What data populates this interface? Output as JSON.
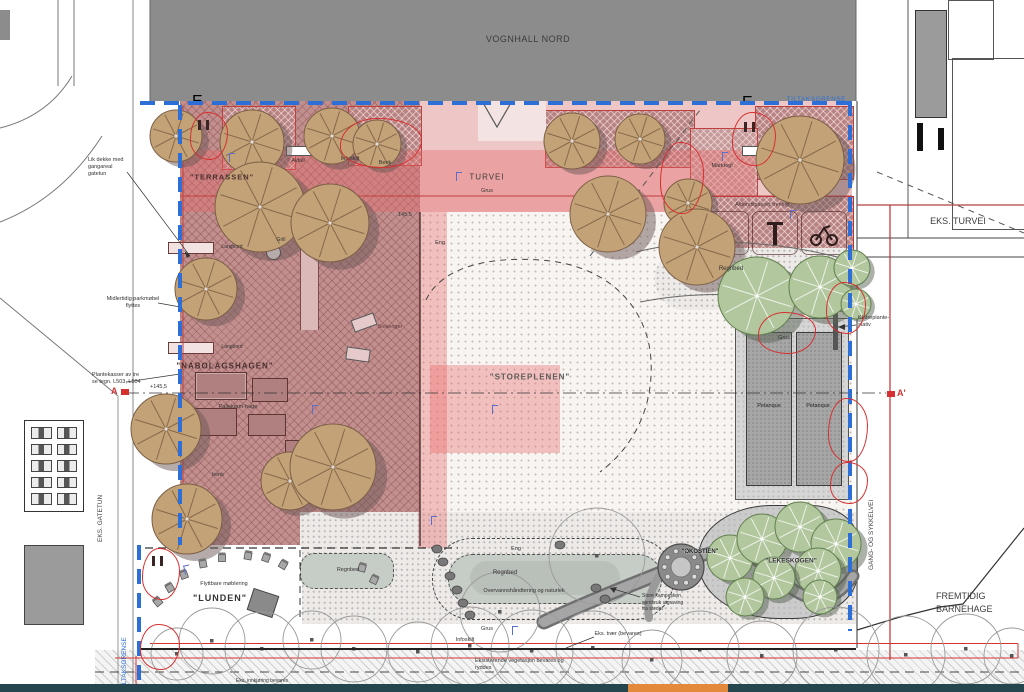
{
  "buildings": {
    "vognhall_nord": "VOGNHALL NORD",
    "fremtidig_barnehage": "FREMTIDIG\nBARNEHAGE"
  },
  "roads": {
    "eks_turvei": "EKS. TURVEI",
    "gang_og_sykkelvei": "GANG- OG SYKKELVEI",
    "eks_gatetun": "EKS. GATETUN"
  },
  "boundary": {
    "tiltaksgrense_top": "TILTAKSGRENSE",
    "tiltaksgrense_left": "TILTAKSGRENSE"
  },
  "areas": {
    "terrassen": "\"TERRASSEN\"",
    "nabolagshagen": "\"NABOLAGSHAGEN\"",
    "storeplenen": "\"STOREPLENEN\"",
    "lunden": "\"LUNDEN\"",
    "lekeskogen": "\"LEKESKOGEN\"",
    "okostien": "\"ØKOSTIEN\""
  },
  "turvei": {
    "name": "TURVEI",
    "surface": "Grus"
  },
  "labels": {
    "avfall": "Avfall",
    "infoskilt": "Infoskilt",
    "benk": "Benk",
    "marktegl": "Marktegl",
    "alderstilpasset_trening": "Alderstilpasset trening",
    "regnbed": "Regnbed",
    "grus": "Grus",
    "petanque": "Petanque",
    "langbord": "Langbord",
    "grill": "Grill",
    "pallekarm_hage": "Pallekarm-hage",
    "benk_small": "benk",
    "solsenger": "Solsenger",
    "eng": "Eng",
    "overvann": "Overvannshåndtering og naturlek",
    "flyttbar_moblering": "Flyttbare møblering",
    "eks_traer": "Eks. trær (bevares)",
    "eks_innkjoring": "Eks. innkjøring bevares"
  },
  "annotations": {
    "lik_dekke": "Lik dekke med\ngangareal\ngatetun",
    "midlertidig_parkmobel": "Midlertidig parkmøbel\nflyttes",
    "plantekasser": "Plantekasser av tre\nse tegn. L503, L504",
    "klatreplante_stativ": "Klatreplante-\nstativ",
    "store_kampestein": "Store kampestein\ngjenbruk utgraving\nfra stedet",
    "eksisterende_vegetasjon": "Eksisterende vegetasjon bevares og\nryddes"
  },
  "elevations": {
    "spot_1": "+145,5",
    "spot_2": "145,5"
  },
  "section": {
    "a": "A",
    "a_prime": "A'"
  },
  "markers": {
    "revision": "E"
  },
  "colors": {
    "boundary_blue": "#2d6fd6",
    "revision_red": "#d63030",
    "overlay_pink": "#e86c6c",
    "building_gray": "#8c8c8c",
    "taskbar_teal": "#25454f",
    "taskbar_orange": "#e2893b"
  }
}
